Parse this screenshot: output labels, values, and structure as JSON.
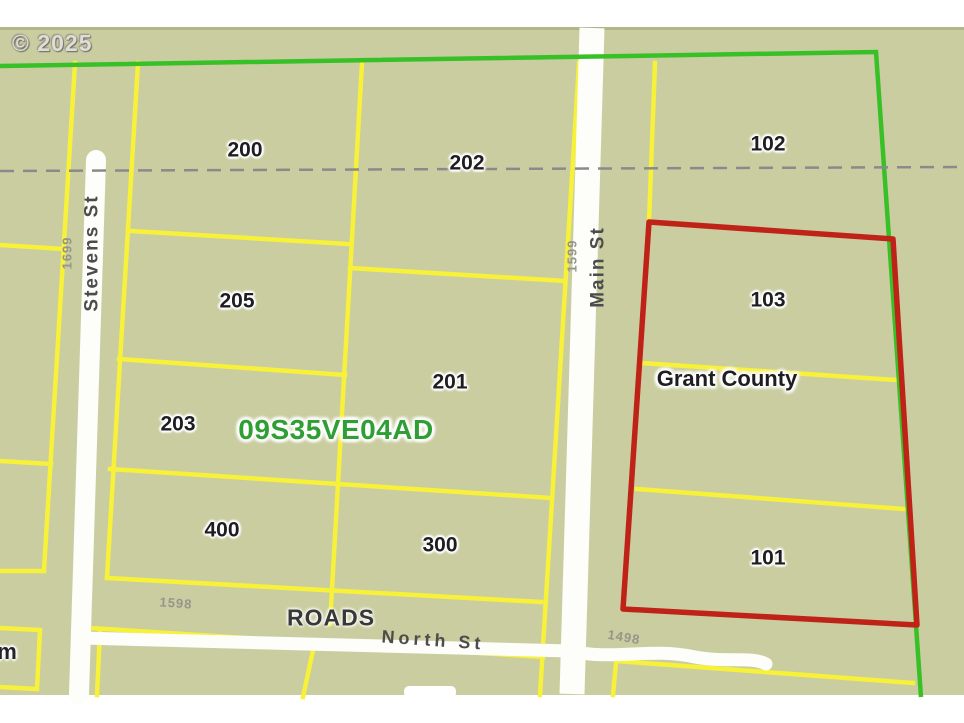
{
  "watermark": {
    "text": "© 2025"
  },
  "map": {
    "plat_id": "09S35VE04AD",
    "county": "Grant County",
    "parcels": [
      {
        "number": "200"
      },
      {
        "number": "202"
      },
      {
        "number": "102"
      },
      {
        "number": "205"
      },
      {
        "number": "201"
      },
      {
        "number": "103"
      },
      {
        "number": "203"
      },
      {
        "number": "400"
      },
      {
        "number": "300"
      },
      {
        "number": "101"
      }
    ],
    "streets": {
      "stevens": "Stevens St",
      "main": "Main St",
      "north": "North St"
    },
    "layer_label": "ROADS",
    "address_numbers": {
      "n1699": "1699",
      "n1599": "1599",
      "n1598": "1598",
      "n1498": "1498"
    },
    "edge_fragment": "m",
    "colors": {
      "background": "#cacda0",
      "parcel_line_yellow": "#f7f13a",
      "boundary_green": "#38c127",
      "selected_parcel_red": "#bf2318",
      "road_white": "#fdfdfa",
      "section_dash_gray": "#8a8a8a",
      "plat_id_green": "#2f9e35"
    }
  }
}
